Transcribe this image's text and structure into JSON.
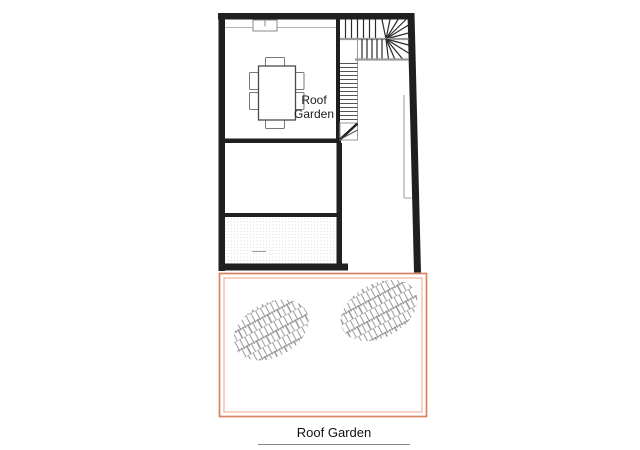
{
  "drawing": {
    "room_label_line1": "Roof",
    "room_label_line2": "Garden",
    "caption": "Roof Garden"
  },
  "colors": {
    "wall": "#1f1f1f",
    "bg": "#ffffff",
    "terrOuter": "#db8261",
    "terrInner": "#f0b8a3",
    "hatch": "#8f8f8f",
    "stair": "#555555",
    "captionText": "#111111"
  }
}
